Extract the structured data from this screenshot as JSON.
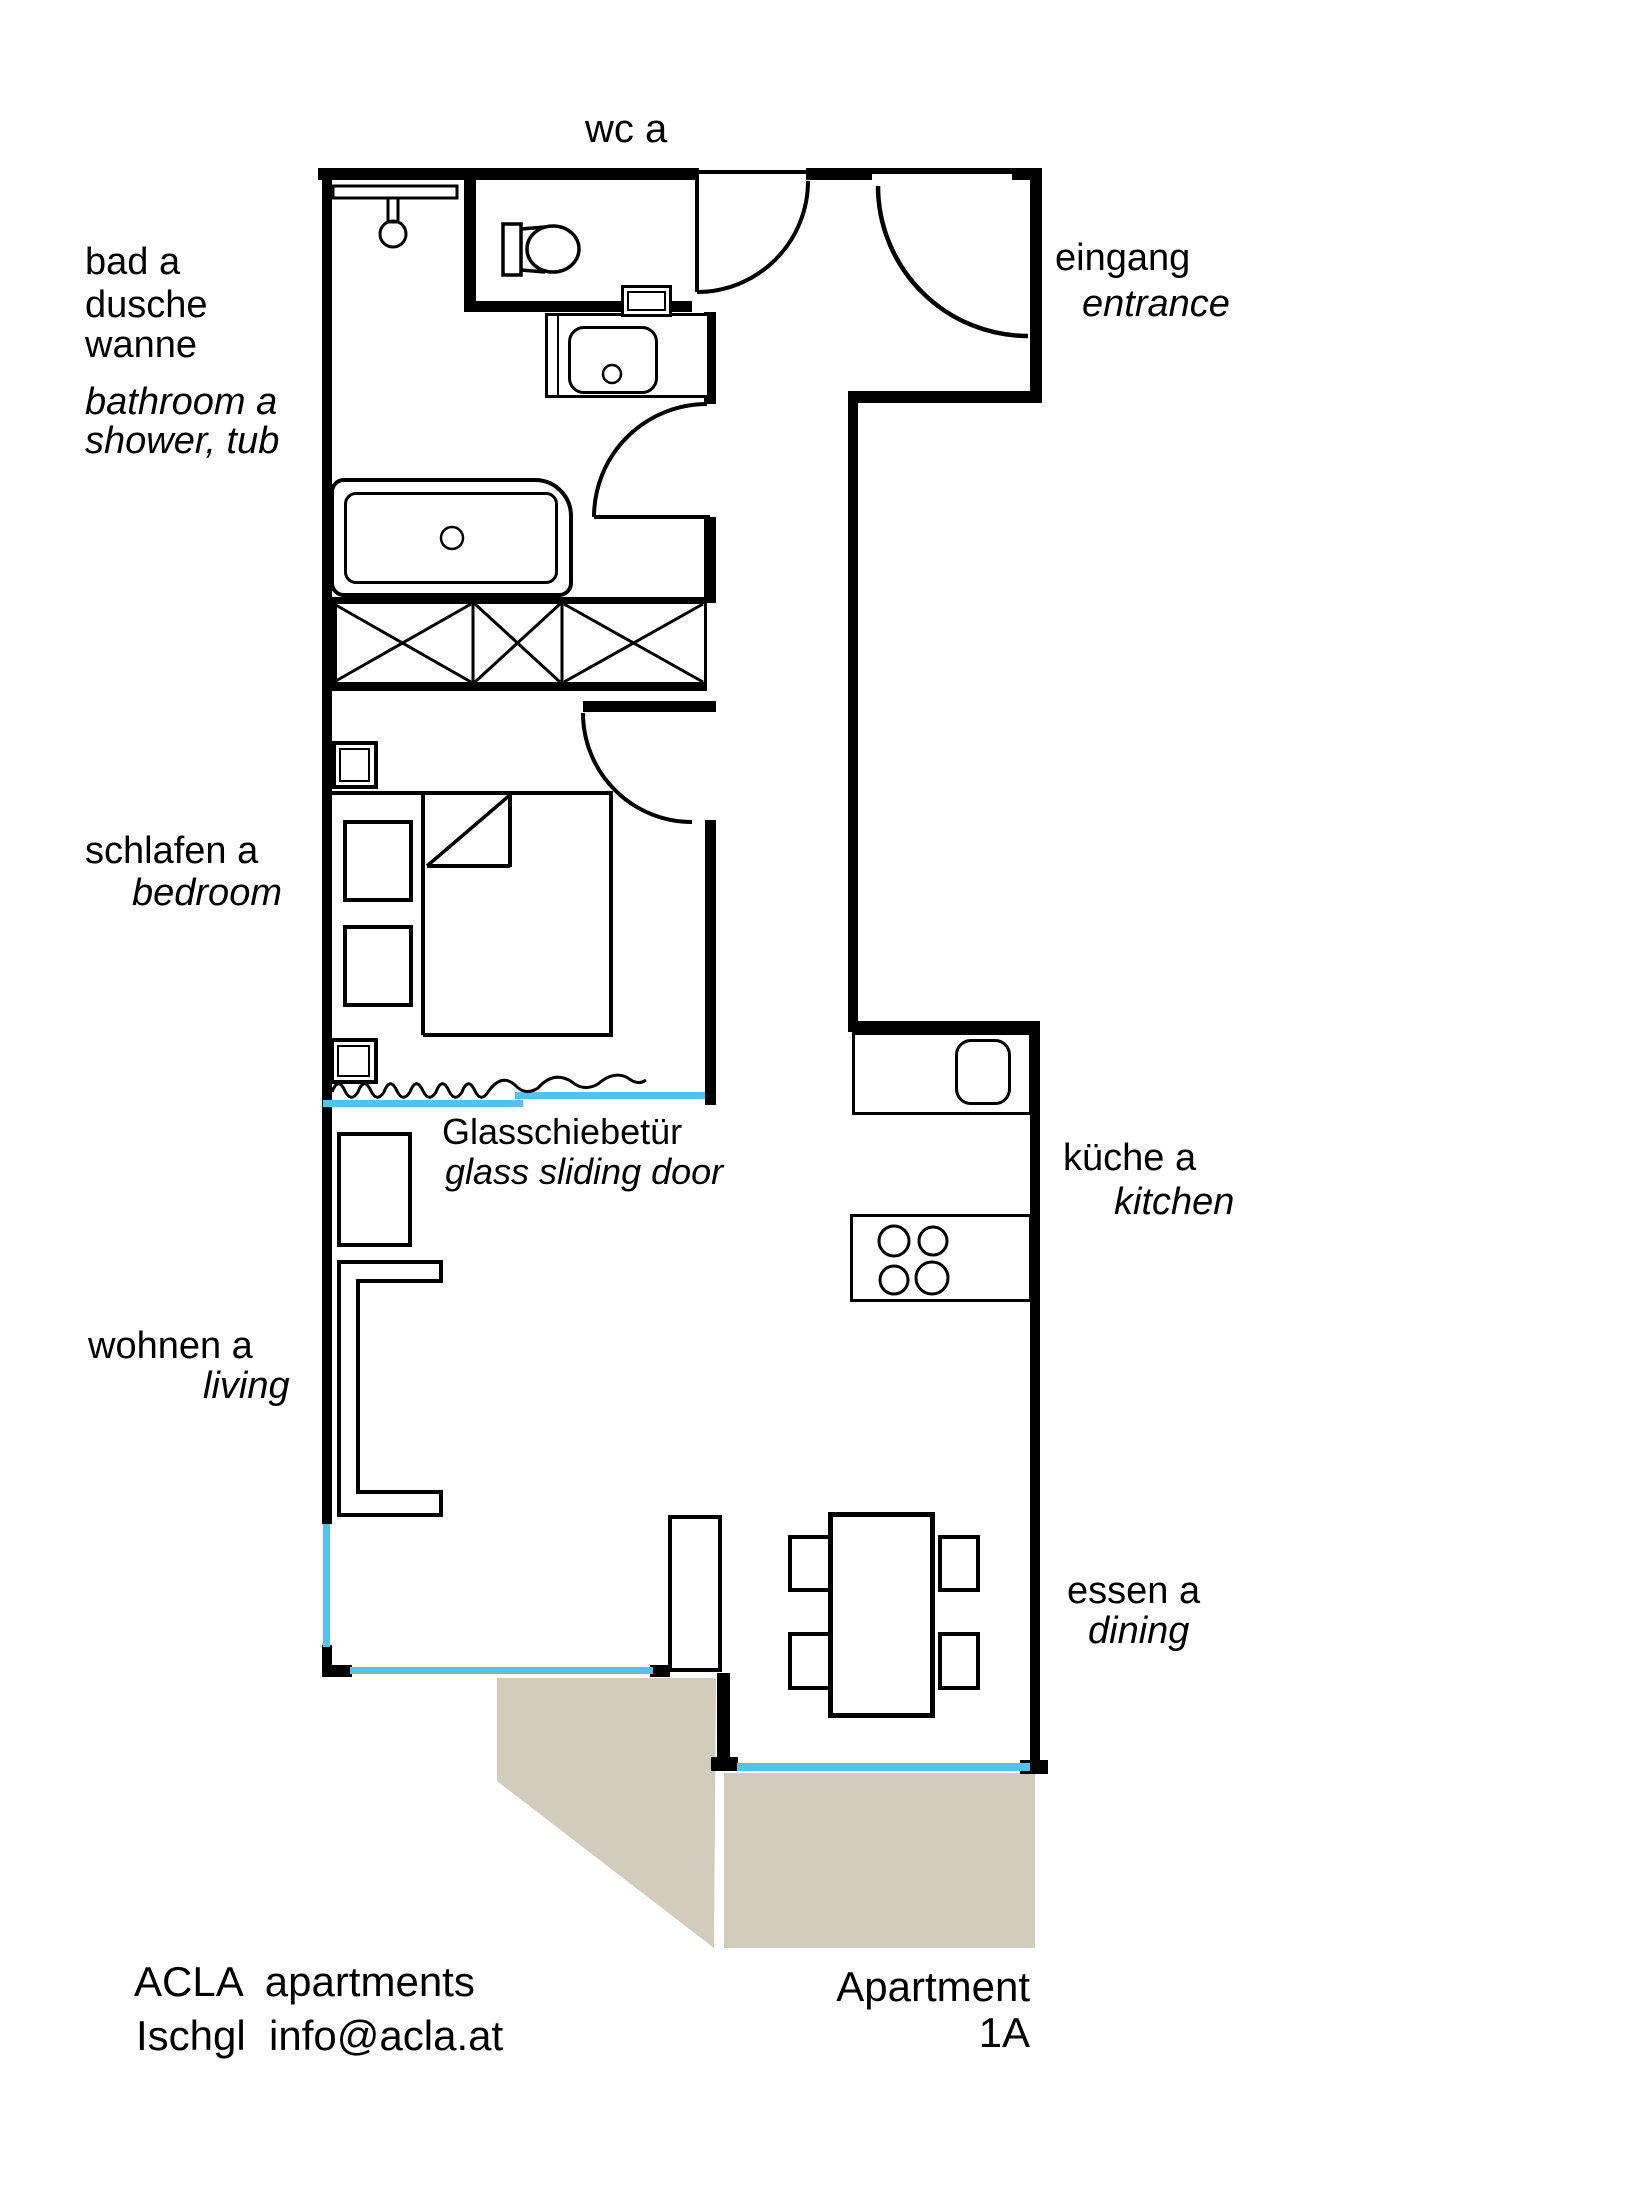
{
  "title": "ACLA apartments floor plan – Apartment 1A",
  "colors": {
    "wall": "#000000",
    "window": "#55c2ee",
    "terrace": "#d2ccbc",
    "background": "#ffffff"
  },
  "rooms": {
    "wc": {
      "de": "wc a"
    },
    "bathroom": {
      "l1": "bad a",
      "l2": "dusche",
      "l3": "wanne",
      "en1": "bathroom a",
      "en2": "shower, tub"
    },
    "entrance": {
      "de": "eingang",
      "en": "entrance"
    },
    "bedroom": {
      "de": "schlafen a",
      "en": "bedroom"
    },
    "sliding_door": {
      "de": "Glasschiebetür",
      "en": "glass sliding door"
    },
    "kitchen": {
      "de": "küche a",
      "en": "kitchen"
    },
    "living": {
      "de": "wohnen a",
      "en": "living"
    },
    "dining": {
      "de": "essen a",
      "en": "dining"
    }
  },
  "footer": {
    "brand_line1": "ACLA  apartments",
    "brand_line2": "Ischgl  info@acla.at",
    "apartment_line1": "Apartment",
    "apartment_line2": "1A"
  }
}
